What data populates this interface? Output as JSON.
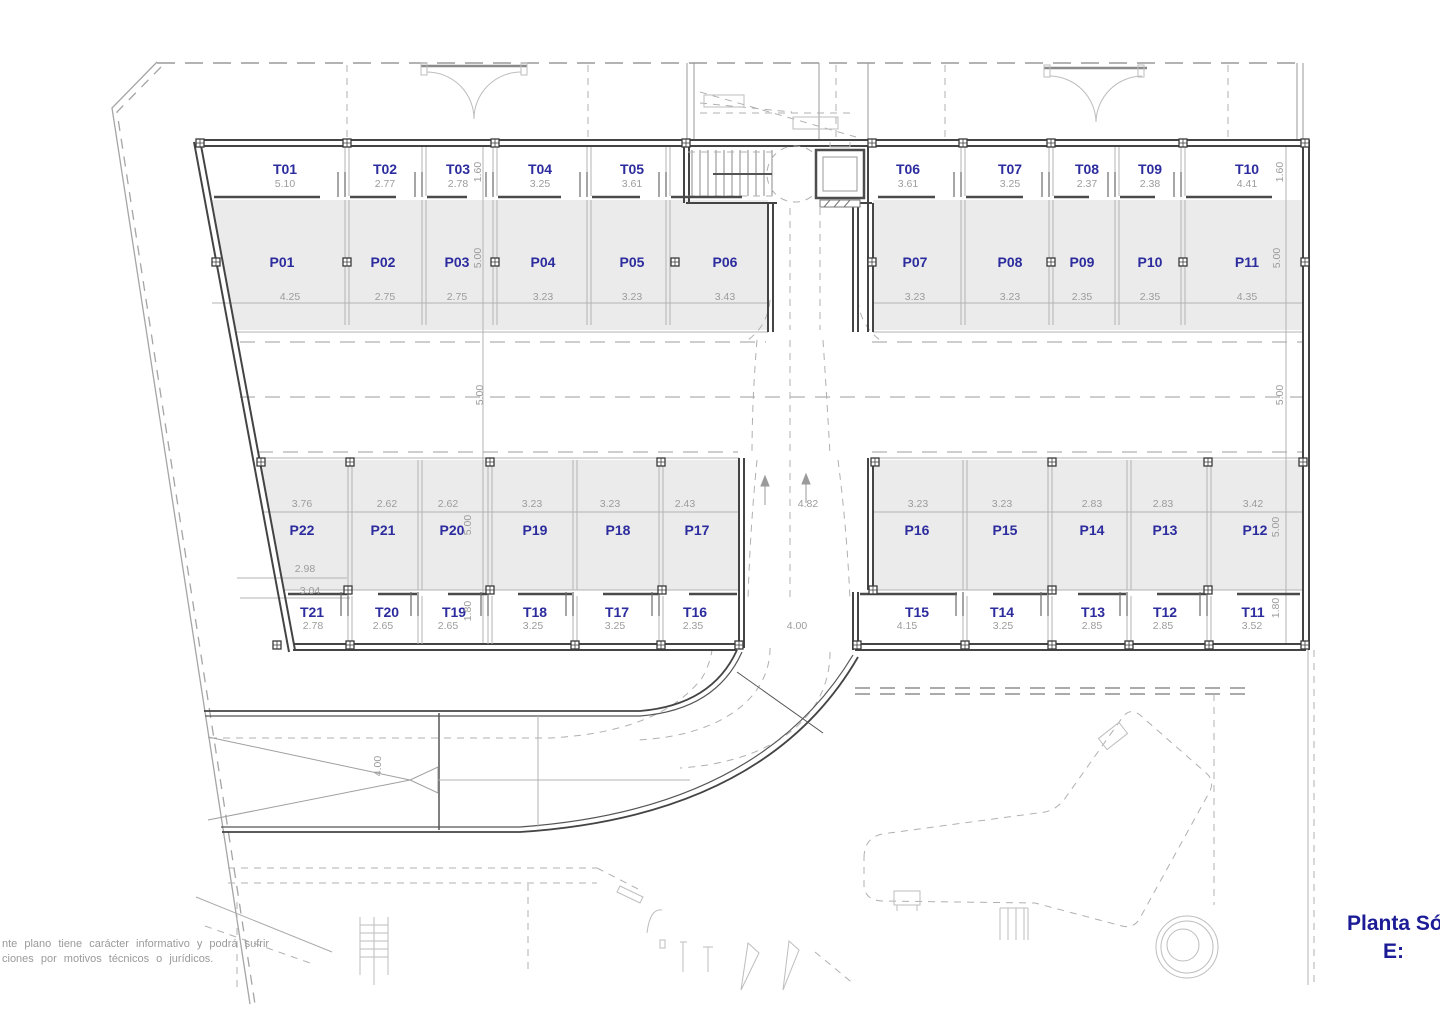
{
  "title": {
    "line1": "Planta Só",
    "line2": "E:"
  },
  "disclaimer": {
    "line1": "nte plano tiene carácter informativo y podrá sufrir",
    "line2": "ciones por motivos técnicos o jurídicos."
  },
  "colors": {
    "label_navy": "#2c2c9e",
    "title_navy": "#1c1c96",
    "dim_gray": "#9c9c9c",
    "wall_dark": "#444444",
    "stall_fill": "#ebebeb"
  },
  "units": {
    "storage_top": [
      {
        "label": "T01",
        "width": "5.10"
      },
      {
        "label": "T02",
        "width": "2.77"
      },
      {
        "label": "T03",
        "width": "2.78"
      },
      {
        "label": "T04",
        "width": "3.25"
      },
      {
        "label": "T05",
        "width": "3.61"
      },
      {
        "label": "T06",
        "width": "3.61"
      },
      {
        "label": "T07",
        "width": "3.25"
      },
      {
        "label": "T08",
        "width": "2.37"
      },
      {
        "label": "T09",
        "width": "2.38"
      },
      {
        "label": "T10",
        "width": "4.41"
      }
    ],
    "parking_top": [
      {
        "label": "P01",
        "width": "4.25"
      },
      {
        "label": "P02",
        "width": "2.75"
      },
      {
        "label": "P03",
        "width": "2.75"
      },
      {
        "label": "P04",
        "width": "3.23"
      },
      {
        "label": "P05",
        "width": "3.23"
      },
      {
        "label": "P06",
        "width": "3.43"
      },
      {
        "label": "P07",
        "width": "3.23"
      },
      {
        "label": "P08",
        "width": "3.23"
      },
      {
        "label": "P09",
        "width": "2.35"
      },
      {
        "label": "P10",
        "width": "2.35"
      },
      {
        "label": "P11",
        "width": "4.35"
      }
    ],
    "parking_bottom": [
      {
        "label": "P22",
        "width": "3.76"
      },
      {
        "label": "P21",
        "width": "2.62"
      },
      {
        "label": "P20",
        "width": "2.62"
      },
      {
        "label": "P19",
        "width": "3.23"
      },
      {
        "label": "P18",
        "width": "3.23"
      },
      {
        "label": "P17",
        "width": "2.43"
      },
      {
        "label": "P16",
        "width": "3.23"
      },
      {
        "label": "P15",
        "width": "3.23"
      },
      {
        "label": "P14",
        "width": "2.83"
      },
      {
        "label": "P13",
        "width": "2.83"
      },
      {
        "label": "P12",
        "width": "3.42"
      }
    ],
    "storage_bottom": [
      {
        "label": "T21",
        "width": "2.78"
      },
      {
        "label": "T20",
        "width": "2.65"
      },
      {
        "label": "T19",
        "width": "2.65"
      },
      {
        "label": "T18",
        "width": "3.25"
      },
      {
        "label": "T17",
        "width": "3.25"
      },
      {
        "label": "T16",
        "width": "2.35"
      },
      {
        "label": "T15",
        "width": "4.15"
      },
      {
        "label": "T14",
        "width": "3.25"
      },
      {
        "label": "T13",
        "width": "2.85"
      },
      {
        "label": "T12",
        "width": "2.85"
      },
      {
        "label": "T11",
        "width": "3.52"
      }
    ]
  },
  "side_dimensions": {
    "left": [
      "1.60",
      "5.00",
      "5.00",
      "5.00",
      "1.80"
    ],
    "right": [
      "1.60",
      "5.00",
      "5.00",
      "5.00",
      "1.80"
    ]
  },
  "other_dimensions": {
    "aisle_junction_width": "4.82",
    "drive_exit_width": "4.00",
    "ramp_width": "4.00",
    "p22_inner_width": "2.98",
    "t21_outer_width": "3.04"
  }
}
